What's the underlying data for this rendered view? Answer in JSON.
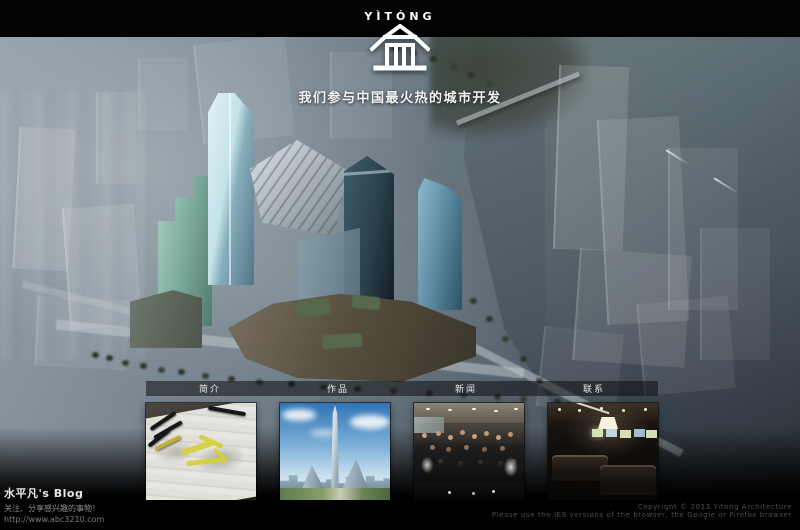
{
  "brand": {
    "wordmark": "YÌTÓNG",
    "tagline": "我们参与中国最火热的城市开发"
  },
  "nav": {
    "items": [
      {
        "label": "简介"
      },
      {
        "label": "作品"
      },
      {
        "label": "新闻"
      },
      {
        "label": "联系"
      }
    ]
  },
  "thumbnails": {
    "items": [
      {
        "name": "masterplan-sketch"
      },
      {
        "name": "tower-rendering"
      },
      {
        "name": "team-photo"
      },
      {
        "name": "office-interior"
      }
    ]
  },
  "footer": {
    "blog": {
      "title": "水平凡's Blog",
      "subtitle": "关注、分享感兴趣的事物！",
      "url": "http://www.abc3210.com"
    },
    "copyright": {
      "line1": "Copyright © 2013 Yitong Architecture",
      "line2": "Please use the IE9 versions of the browser, the Google or Firefox browser"
    }
  },
  "colors": {
    "page_background": "#000000",
    "haze": "#8d99a2",
    "water": "#5d6a76",
    "highlighter_yellow": "#d6cf3a"
  }
}
